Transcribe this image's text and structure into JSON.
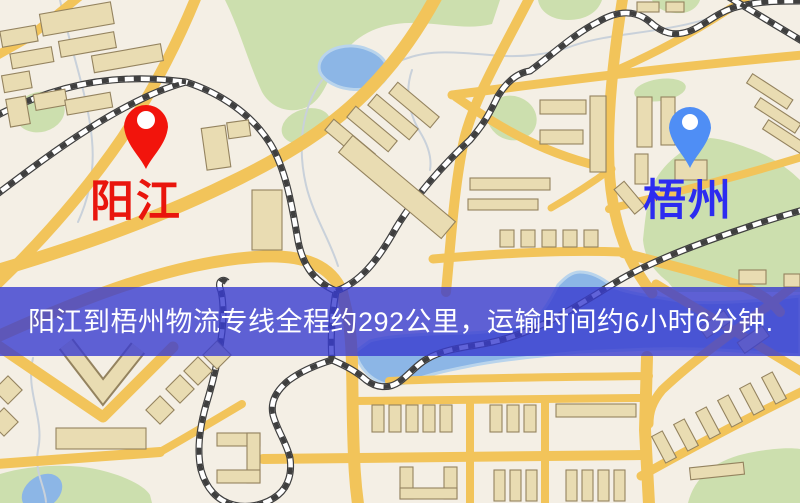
{
  "banner": {
    "text": "阳江到梧州物流专线全程约292公里，运输时间约6小时6分钟.",
    "background": "rgba(56,60,208,0.8)",
    "text_color": "#ffffff"
  },
  "markers": [
    {
      "id": "yangjiang",
      "label": "阳江",
      "label_color": "#e9150d",
      "pin_color": "#f2140c",
      "pin_hole_color": "#ffffff"
    },
    {
      "id": "wuzhou",
      "label": "梧州",
      "label_color": "#2c2cf0",
      "pin_color": "#4f8ef5",
      "pin_hole_color": "#ffffff"
    }
  ],
  "map": {
    "type": "stylized-street-map",
    "palette": {
      "background": "#f4efe5",
      "road": "#f2c45a",
      "park": "#ccdfae",
      "water": "#8cb6e6",
      "water_edge": "#b9d4ec",
      "building": "#e9dcb2",
      "building_outline": "#94835f",
      "railway": "#3f3f3f",
      "stream": "#c9d1da"
    }
  }
}
